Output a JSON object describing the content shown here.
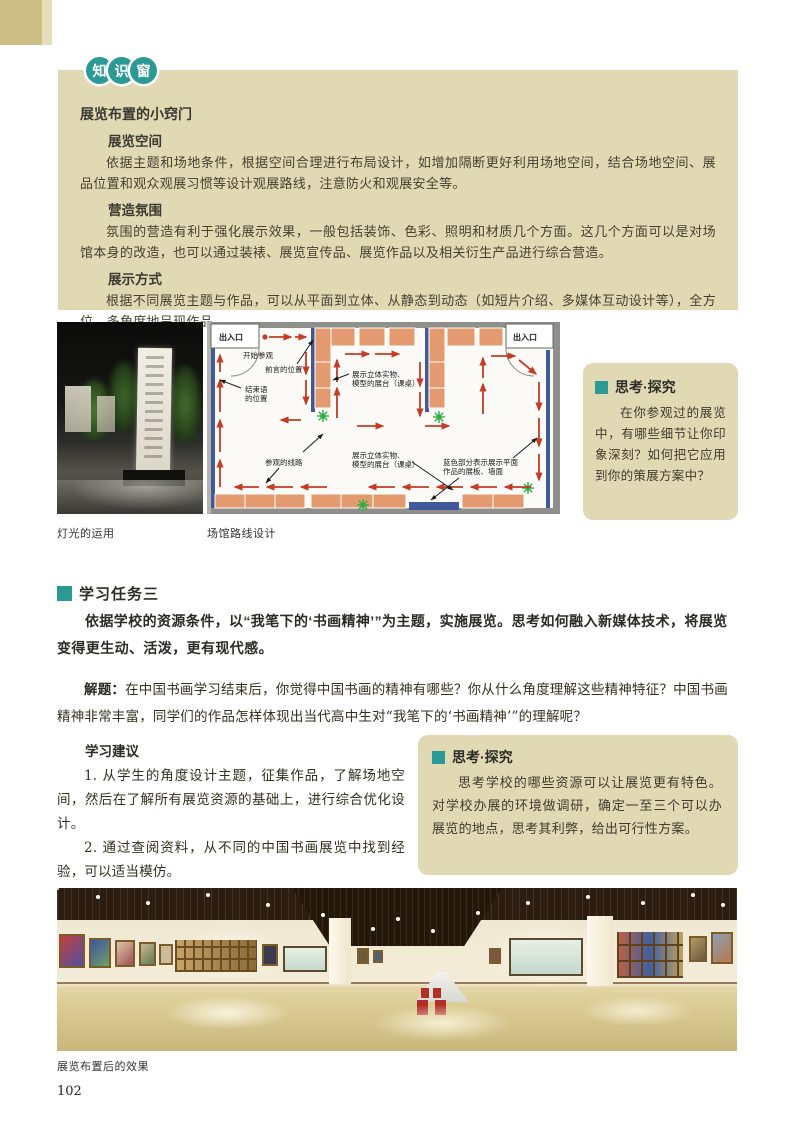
{
  "page": {
    "number": "102"
  },
  "colors": {
    "teal_accent": "#2b9a94",
    "tan_panel": "#e1d9b4",
    "corner_tan": "#cdbf83",
    "plan_wall_blue": "#41589b",
    "plan_platform_salmon": "#e39a6e",
    "plan_arrow_red": "#c43b27",
    "plan_plant_green": "#2fae46"
  },
  "knowledge_window": {
    "badge_chars": [
      "知",
      "识",
      "窗"
    ],
    "title": "展览布置的小窍门",
    "sections": [
      {
        "heading": "展览空间",
        "body": "依据主题和场地条件，根据空间合理进行布局设计，如增加隔断更好利用场地空间，结合场地空间、展品位置和观众观展习惯等设计观展路线，注意防火和观展安全等。"
      },
      {
        "heading": "营造氛围",
        "body": "氛围的营造有利于强化展示效果，一般包括装饰、色彩、照明和材质几个方面。这几个方面可以是对场馆本身的改造，也可以通过装裱、展览宣传品、展览作品以及相关衍生产品进行综合营造。"
      },
      {
        "heading": "展示方式",
        "body": "根据不同展览主题与作品，可以从平面到立体、从静态到动态（如短片介绍、多媒体互动设计等），全方位、多角度地呈现作品。"
      }
    ]
  },
  "figures": {
    "lighting_caption": "灯光的运用",
    "floorplan_caption": "场馆路线设计",
    "panorama_caption": "展览布置后的效果"
  },
  "floorplan": {
    "entrance_left": "出入口",
    "entrance_right": "出入口",
    "start_label": "开始参观",
    "foreword_label": "前言的位置",
    "closing_label_line1": "结束语",
    "closing_label_line2": "的位置",
    "platform1_line1": "展示立体实物、",
    "platform1_line2": "模型的展台（课桌）",
    "platform2_line1": "展示立体实物、",
    "platform2_line2": "模型的展台（课桌）",
    "route_label": "参观的线路",
    "blue_label_line1": "蓝色部分表示展示平面",
    "blue_label_line2": "作品的展板、墙面"
  },
  "think_box_1": {
    "header": "思考·探究",
    "body": "在你参观过的展览中，有哪些细节让你印象深刻？如何把它应用到你的策展方案中？"
  },
  "task_section": {
    "title": "学习任务三",
    "intro": "依据学校的资源条件，以“我笔下的‘书画精神’”为主题，实施展览。思考如何融入新媒体技术，将展览变得更生动、活泼，更有现代感。",
    "jieti_label": "解题：",
    "jieti_body": "在中国书画学习结束后，你觉得中国书画的精神有哪些？你从什么角度理解这些精神特征？中国书画精神非常丰富，同学们的作品怎样体现出当代高中生对“我笔下的‘书画精神’”的理解呢？",
    "advice_title": "学习建议",
    "advice_items": [
      "1. 从学生的角度设计主题，征集作品，了解场地空间，然后在了解所有展览资源的基础上，进行综合优化设计。",
      "2. 通过查阅资料，从不同的中国书画展览中找到经验，可以适当模仿。"
    ]
  },
  "think_box_2": {
    "header": "思考·探究",
    "body": "思考学校的哪些资源可以让展览更有特色。对学校办展的环境做调研，确定一至三个可以办展览的地点，思考其利弊，给出可行性方案。"
  }
}
